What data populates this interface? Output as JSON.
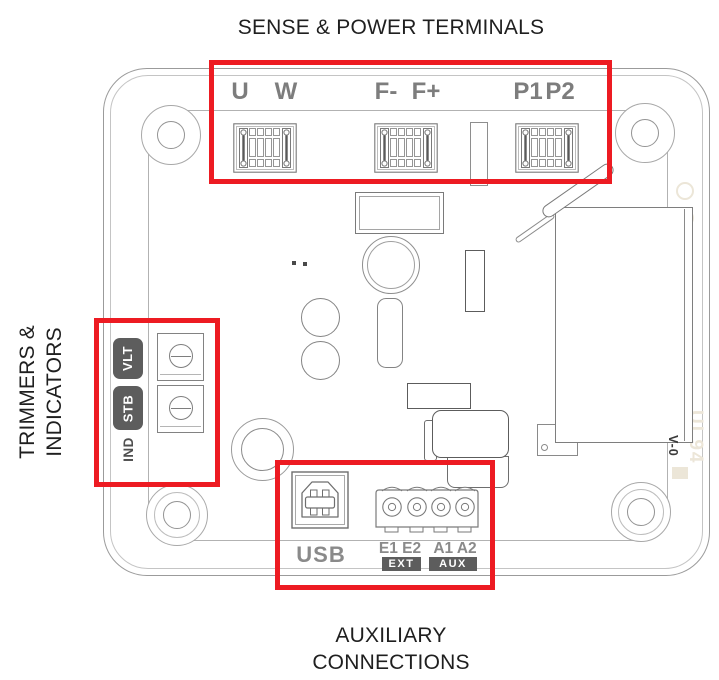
{
  "figure": {
    "top_caption": "SENSE & POWER TERMINALS",
    "left_caption_line1": "TRIMMERS &",
    "left_caption_line2": "INDICATORS",
    "bottom_caption_line1": "AUXILIARY",
    "bottom_caption_line2": "CONNECTIONS"
  },
  "sense_power_terminals": {
    "labels": [
      "U",
      "W",
      "F-",
      "F+",
      "P1",
      "P2"
    ]
  },
  "trimmers_indicators": {
    "trimmer_badge_1": "VLT",
    "trimmer_badge_2": "STB",
    "indicator_label": "IND"
  },
  "auxiliary_connections": {
    "usb_label": "USB",
    "pin_group_ext": "E1 E2",
    "pin_group_aux": "A1 A2",
    "badge_ext": "EXT",
    "badge_aux": "AUX"
  },
  "board_markings": {
    "flammability_rating": "V-0",
    "watermark": "UL94"
  },
  "colors": {
    "highlight_red": "#ed1b22",
    "terminal_label_gray": "#7d7d7d",
    "badge_gray": "#5d5d5d",
    "caption_black": "#1f1f1f",
    "line_gray": "#9b9b9b"
  }
}
